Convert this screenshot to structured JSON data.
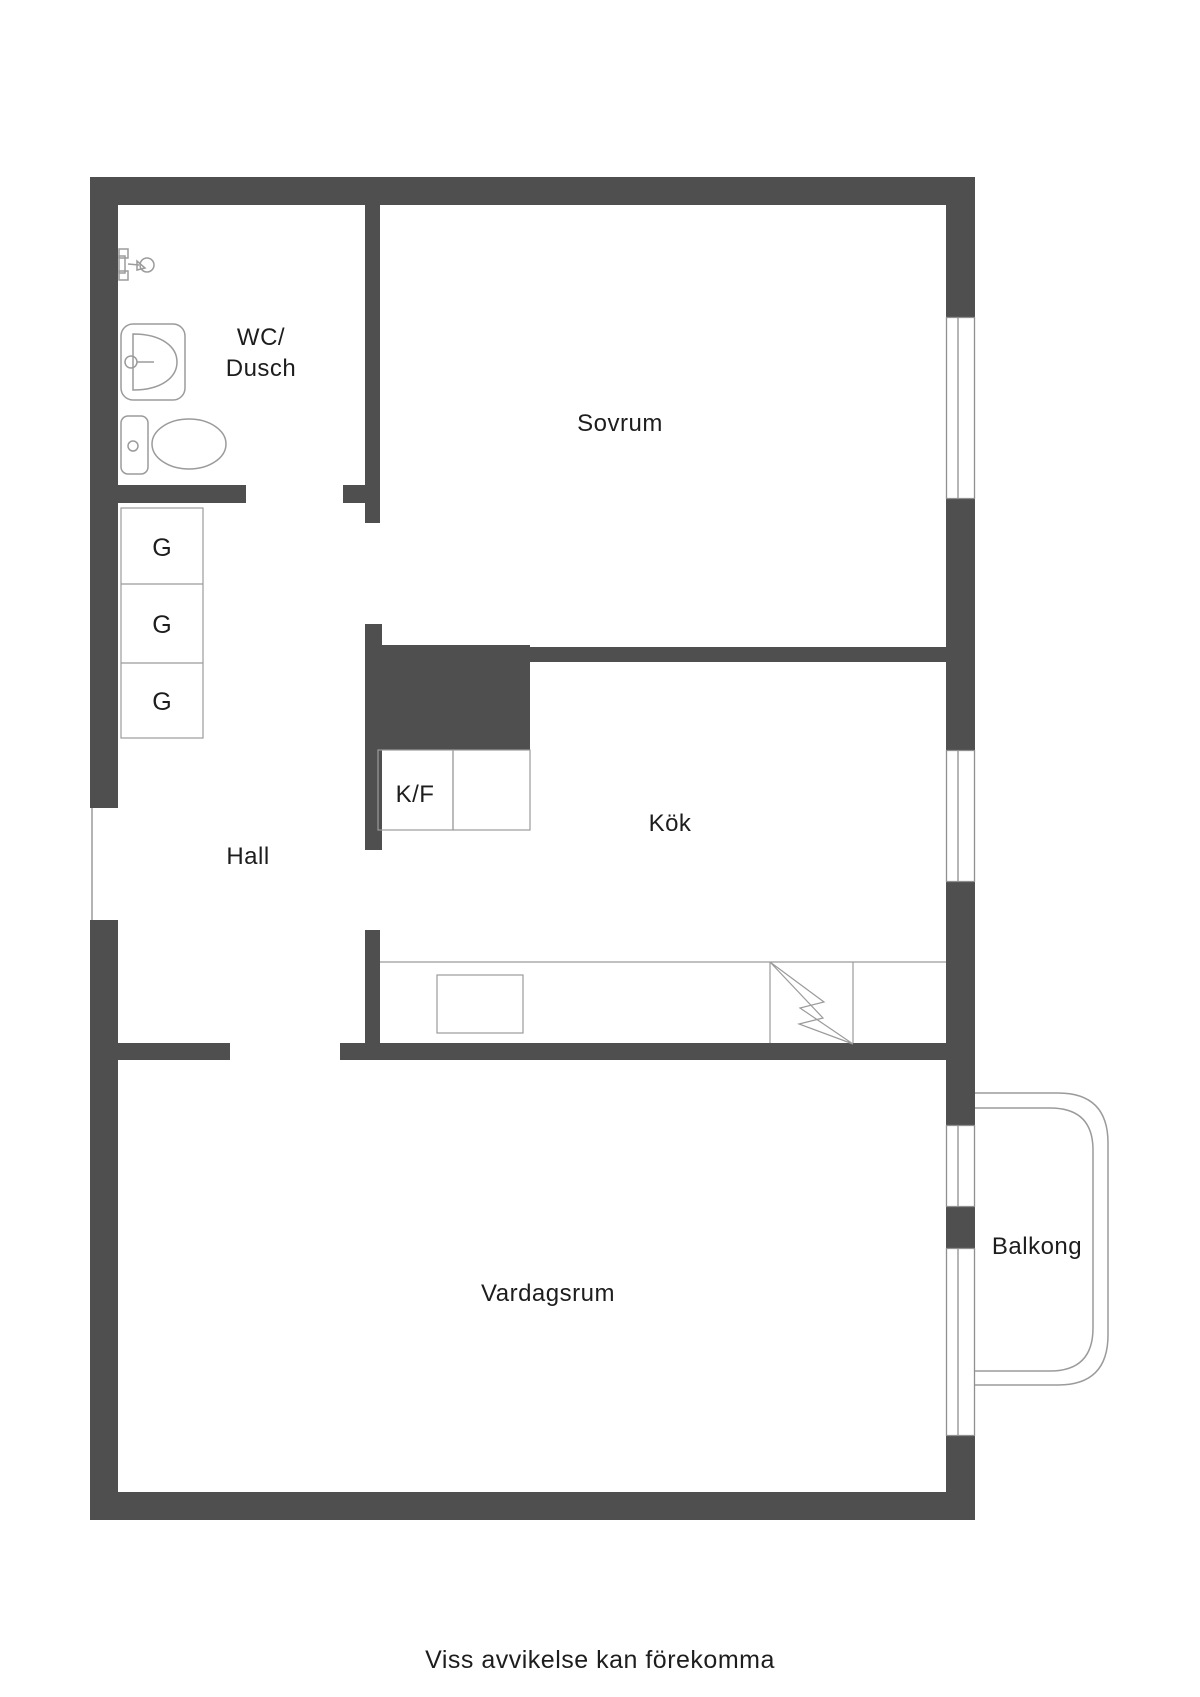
{
  "colors": {
    "background": "#ffffff",
    "wall": "#4f4f4f",
    "fixture_line": "#9b9b9b",
    "window_line": "#8f8f8f",
    "text": "#1d1d1d"
  },
  "rooms": {
    "wc_dusch": {
      "label_line1": "WC/",
      "label_line2": "Dusch"
    },
    "sovrum": {
      "label": "Sovrum"
    },
    "hall": {
      "label": "Hall"
    },
    "kok": {
      "label": "Kök"
    },
    "kf": {
      "label": "K/F"
    },
    "vardagsrum": {
      "label": "Vardagsrum"
    },
    "balkong": {
      "label": "Balkong"
    }
  },
  "closets": {
    "items": [
      {
        "label": "G"
      },
      {
        "label": "G"
      },
      {
        "label": "G"
      }
    ]
  },
  "fixtures": {
    "icons": [
      "shower-icon",
      "bathroom-sink-icon",
      "toilet-icon",
      "kitchen-counter",
      "kitchen-sink",
      "stove-lightning-icon",
      "fridge-freezer-cabinets",
      "window-symbol",
      "balcony-railing",
      "entrance-opening"
    ]
  },
  "footer": {
    "note": "Viss avvikelse kan förekomma"
  }
}
